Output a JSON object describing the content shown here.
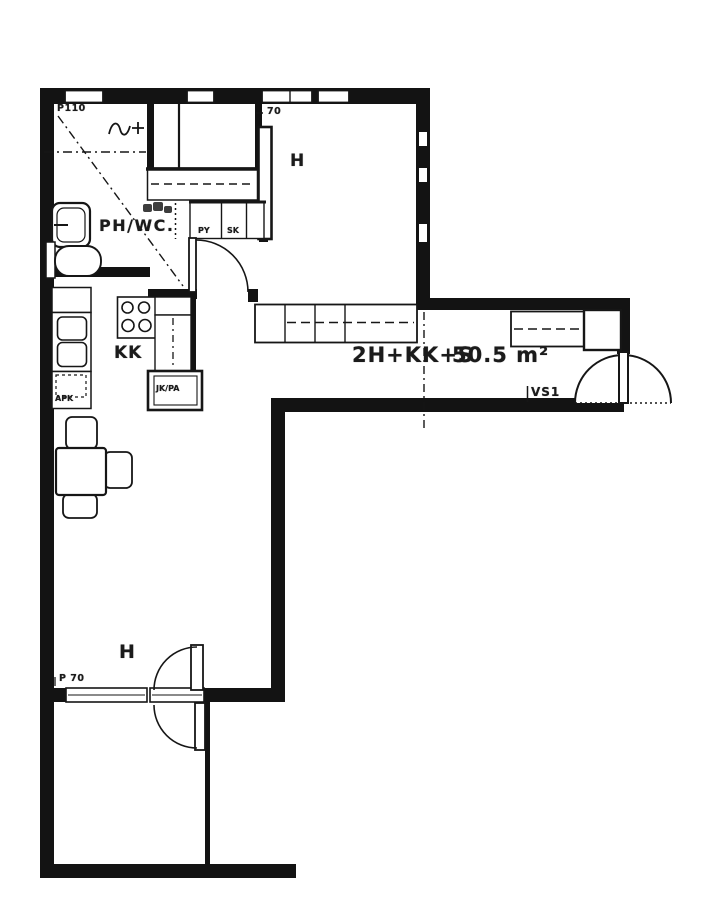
{
  "plan": {
    "paper_color": "#ffffff",
    "ink_color": "#161616",
    "apartment": {
      "type_label": "2H+KK+S",
      "area_label": "50.5 m²"
    },
    "rooms": {
      "bathroom": "PH/WC.",
      "kitchenette": "KK",
      "room_top": "H",
      "room_bottom": "H"
    },
    "fixtures": {
      "fridge_freezer": "JK/PA",
      "dishwasher": "APK",
      "closet_py": "PY",
      "closet_sk": "SK"
    },
    "annotations": {
      "partition_wall": "VS1",
      "top_left_mark": "P110",
      "window_dim_top": "70",
      "window_dim_bottom": "P 70"
    }
  }
}
